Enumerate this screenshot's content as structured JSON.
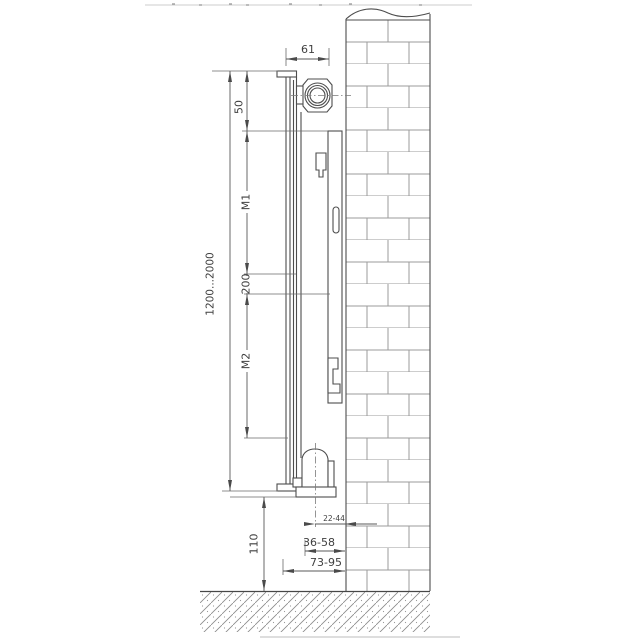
{
  "diagram": {
    "type": "technical-drawing",
    "dim_labels": {
      "depth": "61",
      "top_to_bracket": "50",
      "m1": "M1",
      "bracket_gap": "200",
      "m2": "M2",
      "height_range": "1200...2000",
      "floor_clearance": "110",
      "wall_to_pipe": "22-44",
      "wall_to_valve": "36-58",
      "wall_to_front": "73-95"
    },
    "colors": {
      "line": "#4d4d4d",
      "dimension": "#5a5a5a",
      "brick": "#9b9b9b",
      "text": "#3f3f3f",
      "background": "#ffffff"
    }
  }
}
